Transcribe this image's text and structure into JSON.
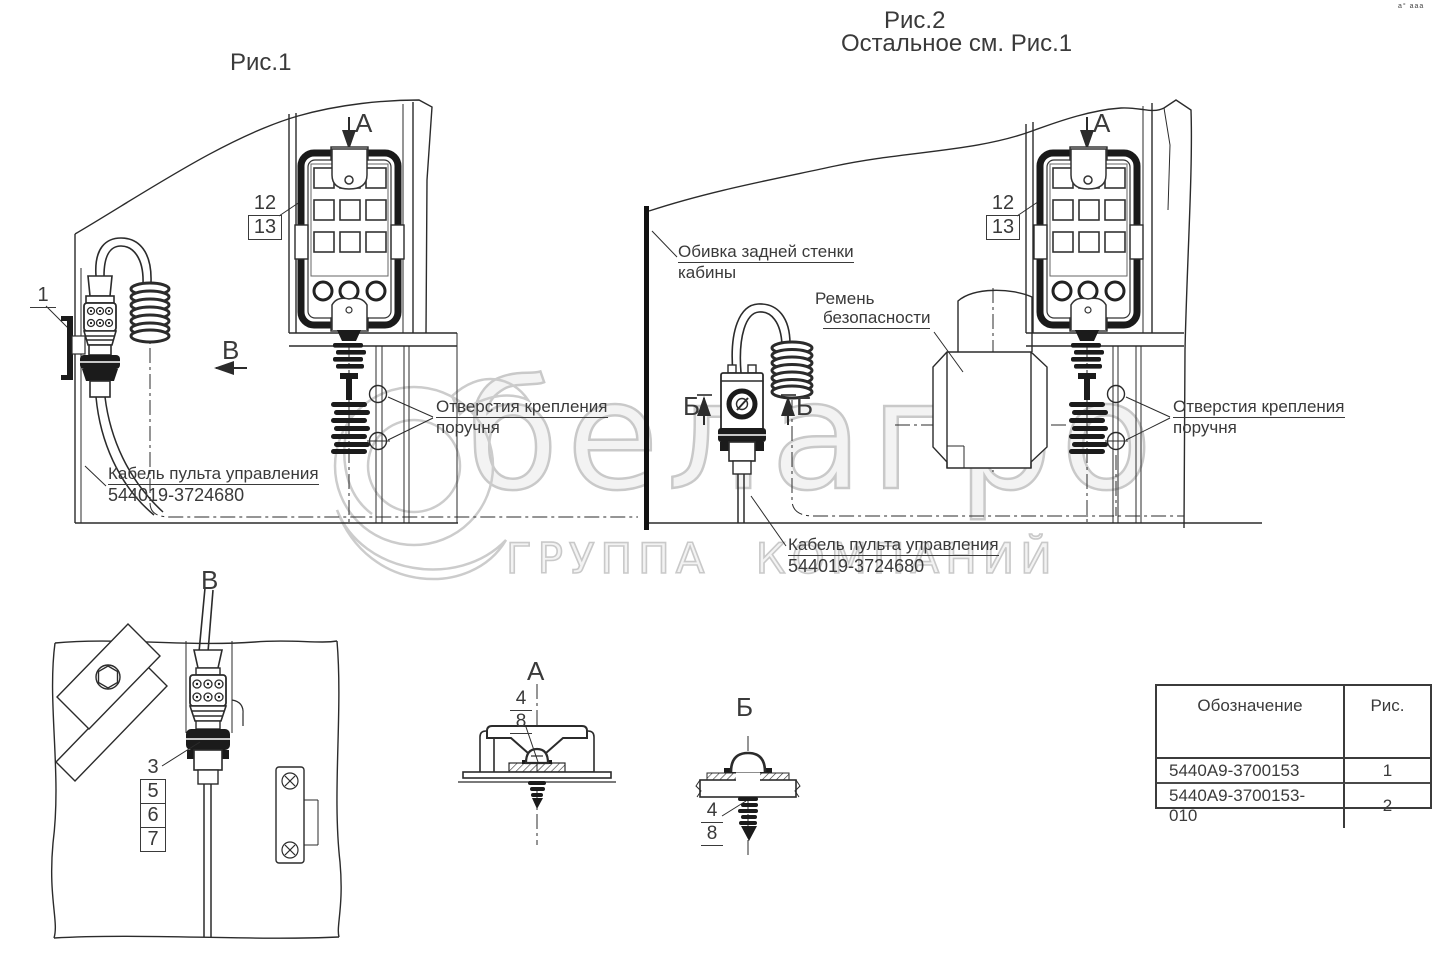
{
  "figure1": {
    "title": "Рис.1",
    "view_arrow_a": "А",
    "view_arrow_b": "В",
    "callout_12": "12",
    "callout_13": "13",
    "callout_1": "1",
    "holes_line1": "Отверстия крепления",
    "holes_line2": "поручня",
    "cable_line1": "Кабель пульта управления",
    "cable_line2": "544019-3724680"
  },
  "figure2": {
    "title": "Рис.2",
    "subtitle": "Остальное см. Рис.1",
    "view_arrow_a": "А",
    "view_arrow_b": "Б",
    "callout_12": "12",
    "callout_13": "13",
    "trim_line1": "Обивка задней стенки",
    "trim_line2": "кабины",
    "belt_line1": "Ремень",
    "belt_line2": "безопасности",
    "holes_line1": "Отверстия крепления",
    "holes_line2": "поручня",
    "cable_line1": "Кабель пульта управления",
    "cable_line2": "544019-3724680"
  },
  "detail_b": {
    "title": "В",
    "callout_3": "3",
    "callout_5": "5",
    "callout_6": "6",
    "callout_7": "7"
  },
  "detail_a": {
    "title": "А",
    "callout_4": "4",
    "callout_8": "8"
  },
  "detail_b2": {
    "title": "Б",
    "callout_4": "4",
    "callout_8": "8"
  },
  "parts_table": {
    "header_designation": "Обозначение",
    "header_fig": "Рис.",
    "rows": [
      {
        "designation": "5440A9-3700153",
        "fig": "1"
      },
      {
        "designation": "5440A9-3700153-010",
        "fig": "2"
      }
    ]
  },
  "watermark": {
    "brand": "белагро",
    "tagline": "ГРУППА КОМПАНИЙ"
  },
  "page": {
    "corner_marks": "а° ааа"
  },
  "colors": {
    "line": "#2b2b2b",
    "text": "#3a3a3a",
    "watermark": "#c9c9c9",
    "fill_dark": "#1b1b1b"
  }
}
